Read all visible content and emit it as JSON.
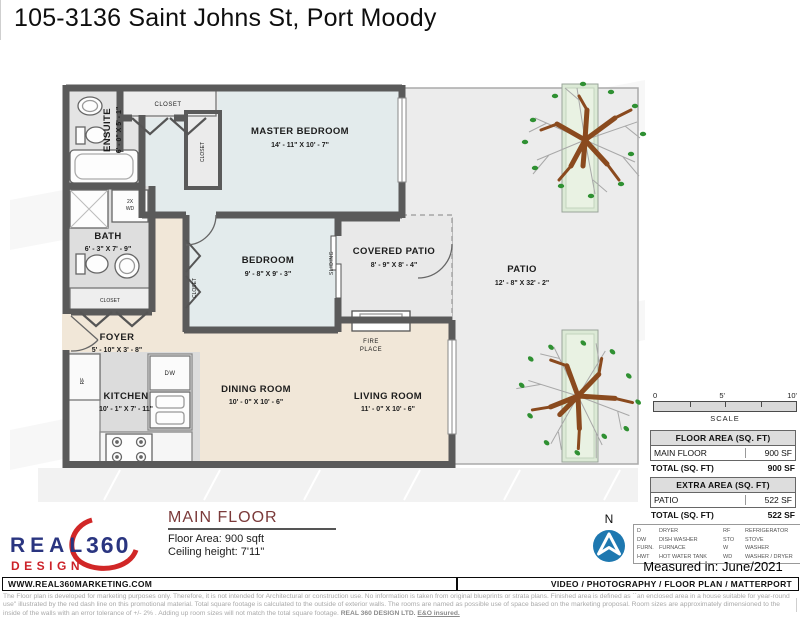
{
  "title": "105-3136 Saint Johns St, Port Moody",
  "plan": {
    "rooms": [
      {
        "name": "MASTER BEDROOM",
        "dims": "14' - 11\" X 10' - 7\""
      },
      {
        "name": "BEDROOM",
        "dims": "9' - 8\" X 9' - 3\""
      },
      {
        "name": "ENSUITE",
        "dims": "6' - 0\" X 5' - 1\""
      },
      {
        "name": "BATH",
        "dims": "6' - 3\" X 7' - 9\""
      },
      {
        "name": "FOYER",
        "dims": "5' - 10\" X 3' - 8\""
      },
      {
        "name": "KITCHEN",
        "dims": "10' - 1\" X 7' - 11\""
      },
      {
        "name": "DINING ROOM",
        "dims": "10' - 0\" X 10' - 6\""
      },
      {
        "name": "LIVING ROOM",
        "dims": "11' - 0\" X 10' - 6\""
      },
      {
        "name": "COVERED PATIO",
        "dims": "8' - 9\" X 8' - 4\""
      },
      {
        "name": "PATIO",
        "dims": "12' - 8\" X 32' - 2\""
      }
    ],
    "labels": {
      "closet": "CLOSET",
      "sliding": "SLIDING",
      "fire1": "FIRE",
      "fire2": "PLACE",
      "wd1": "2X",
      "wd2": "WD",
      "dw": "DW",
      "rf": "RF"
    }
  },
  "scale": {
    "t0": "0",
    "t5": "5'",
    "t10": "10'",
    "label": "SCALE"
  },
  "tables": {
    "floor_area": {
      "header": "FLOOR AREA (SQ. FT)",
      "row_label": "MAIN FLOOR",
      "row_value": "900 SF",
      "total_label": "TOTAL (SQ. FT)",
      "total_value": "900 SF"
    },
    "extra_area": {
      "header": "EXTRA AREA (SQ. FT)",
      "row_label": "PATIO",
      "row_value": "522 SF",
      "total_label": "TOTAL (SQ. FT)",
      "total_value": "522 SF"
    }
  },
  "legend": {
    "items": [
      {
        "abbr": "D",
        "label": "DRYER"
      },
      {
        "abbr": "DW",
        "label": "DISH WASHER"
      },
      {
        "abbr": "FURN.",
        "label": "FURNACE"
      },
      {
        "abbr": "HWT",
        "label": "HOT WATER TANK"
      },
      {
        "abbr": "RF",
        "label": "REFRIGERATOR"
      },
      {
        "abbr": "STO",
        "label": "STOVE"
      },
      {
        "abbr": "W",
        "label": "WASHER"
      },
      {
        "abbr": "WD",
        "label": "WASHER / DRYER"
      }
    ]
  },
  "measured": "Measured in: June/2021",
  "north_label": "N",
  "logo": {
    "real": "REAL",
    "num": "360",
    "design": "DESIGN"
  },
  "floor_info": {
    "title": "MAIN FLOOR",
    "area": "Floor Area: 900 sqft",
    "ceiling": "Ceiling height: 7'11\""
  },
  "footer": {
    "left": "WWW.REAL360MARKETING.COM",
    "right": "VIDEO / PHOTOGRAPHY / FLOOR PLAN / MATTERPORT"
  },
  "disclaimer": {
    "text": "The Floor plan is developed for marketing purposes only. Therefore, it is not intended for Architectural or construction use. No information is taken from original blueprints or strata plans. Finished area is defined as ``an enclosed area in a house suitable for year-round use'' illustrated by the red dash line on this promotional material. Total square footage is calculated to the outside of exterior walls. The rooms are named as possible use of space based on the marketing proposal. Room sizes are approximately dimensioned to the inside of the walls with an error tolerance of +/- 2% . Adding up room sizes will not match the total square footage.",
    "company": "REAL 360 DESIGN LTD.",
    "eo": "E&O insured."
  },
  "colors": {
    "wall": "#5a5a5a",
    "floor_main": "#f1e7d8",
    "floor_bedroom": "#e3ebec",
    "patio": "#ececec",
    "planter": "#dcead6",
    "tree_leaf": "#2f9032",
    "tree_trunk": "#8a4a1e",
    "north_blue": "#1e78b0",
    "logo_navy": "#2a3580",
    "logo_red": "#cc2229",
    "heading_maroon": "#7b3a3a"
  }
}
